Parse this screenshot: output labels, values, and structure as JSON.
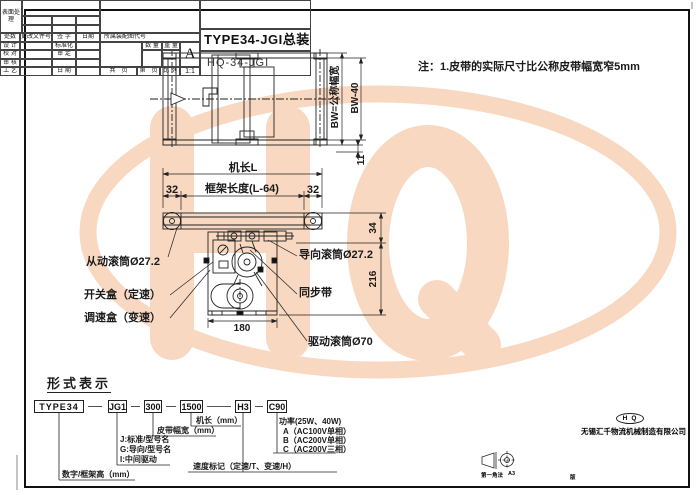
{
  "note": "注：1.皮带的实际尺寸比公称皮带幅宽窄5mm",
  "watermark": {
    "text": "HQ",
    "color": "#f8d8c0"
  },
  "top_view": {
    "bw_label": "BW=公称幅宽",
    "bw40_label": "BW-40",
    "dim_11": "11"
  },
  "side_view": {
    "machine_length": "机长L",
    "frame_length": "框架长度(L-64)",
    "dim_32": "32",
    "dim_34": "34",
    "dim_216": "216",
    "dim_180": "180",
    "driven_roller": "从动滚筒Ø27.2",
    "guide_roller": "导向滚筒Ø27.2",
    "sync_belt": "同步带",
    "drive_roller": "驱动滚筒Ø70",
    "switch_box": "开关盒（定速）",
    "speed_box": "调速盒（变速）"
  },
  "designation": {
    "title": "形式表示",
    "seg_type": "TYPE34",
    "seg_model": "JG1",
    "seg_width": "300",
    "seg_length": "1500",
    "seg_speed": "H3",
    "seg_power": "C90",
    "lbl_length": "机长（mm）",
    "lbl_belt_width": "皮带幅宽（mm）",
    "lbl_j": "J:标准/型号名",
    "lbl_g": "G:导向/型号名",
    "lbl_i": "I:中间驱动",
    "lbl_frame_height": "数字/框架高（mm）",
    "lbl_speed_mark": "速度标记（定速/T、变速/H）",
    "lbl_power": "功率(25W、40W)",
    "lbl_power_a": "A（AC100V单相）",
    "lbl_power_b": "B（AC200V单相）",
    "lbl_power_c": "C（AC200V三相）"
  },
  "title_block": {
    "surface": "表面处理",
    "col_count": "处数",
    "col_doc": "更改文件号",
    "col_sign": "签 字",
    "col_date": "日期",
    "row_design": "设 计",
    "row_check": "校 对",
    "row_review": "审 核",
    "row_process": "工 艺",
    "row_standard": "标准化",
    "row_approve": "审 定",
    "row_date": "日 期",
    "assembly_code": "所属装配图代号",
    "qty": "数 量",
    "weight": "重 量",
    "version": "A",
    "version_suffix": "版",
    "projection": "第一角法",
    "sheet_size": "A3",
    "pages_total": "共　页",
    "pages_no": "第　页",
    "scale_label": "比 例",
    "scale_value": "1:1",
    "logo": "HQ",
    "company": "无锡汇千物流机械制造有限公司",
    "title": "TYPE34-JGI总装图",
    "drawing_no": "HQ-34-JGI"
  }
}
